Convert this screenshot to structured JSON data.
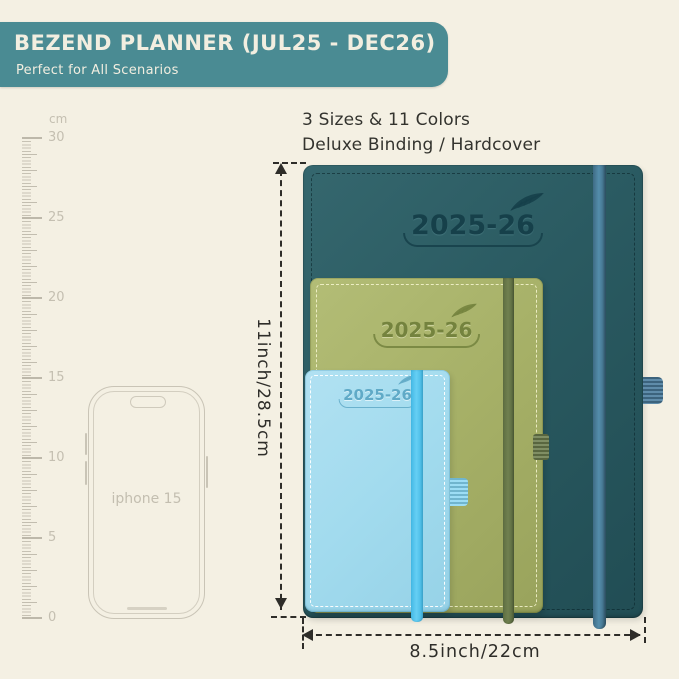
{
  "background_color": "#f4f0e3",
  "banner": {
    "title": "BEZEND PLANNER (JUL25 - DEC26)",
    "subtitle": "Perfect for All Scenarios",
    "bg_color": "#4a8b93",
    "text_color": "#f2eee0"
  },
  "info": {
    "line1": "3 Sizes & 11 Colors",
    "line2": "Deluxe Binding / Hardcover"
  },
  "ruler": {
    "unit": "cm",
    "labels": [
      "30",
      "25",
      "20",
      "15",
      "10",
      "5",
      "0"
    ]
  },
  "phone": {
    "label": "iphone 15"
  },
  "planners": [
    {
      "size": "large",
      "year": "2025-26",
      "cover_color": "#2a5a61",
      "band_color": "#4d7fa0"
    },
    {
      "size": "medium",
      "year": "2025-26",
      "cover_color": "#a6b067",
      "band_color": "#68784a"
    },
    {
      "size": "small",
      "year": "2025-26",
      "cover_color": "#a2dbee",
      "band_color": "#55c8ef"
    }
  ],
  "dimensions": {
    "height_label": "11inch/28.5cm",
    "width_label": "8.5inch/22cm"
  }
}
